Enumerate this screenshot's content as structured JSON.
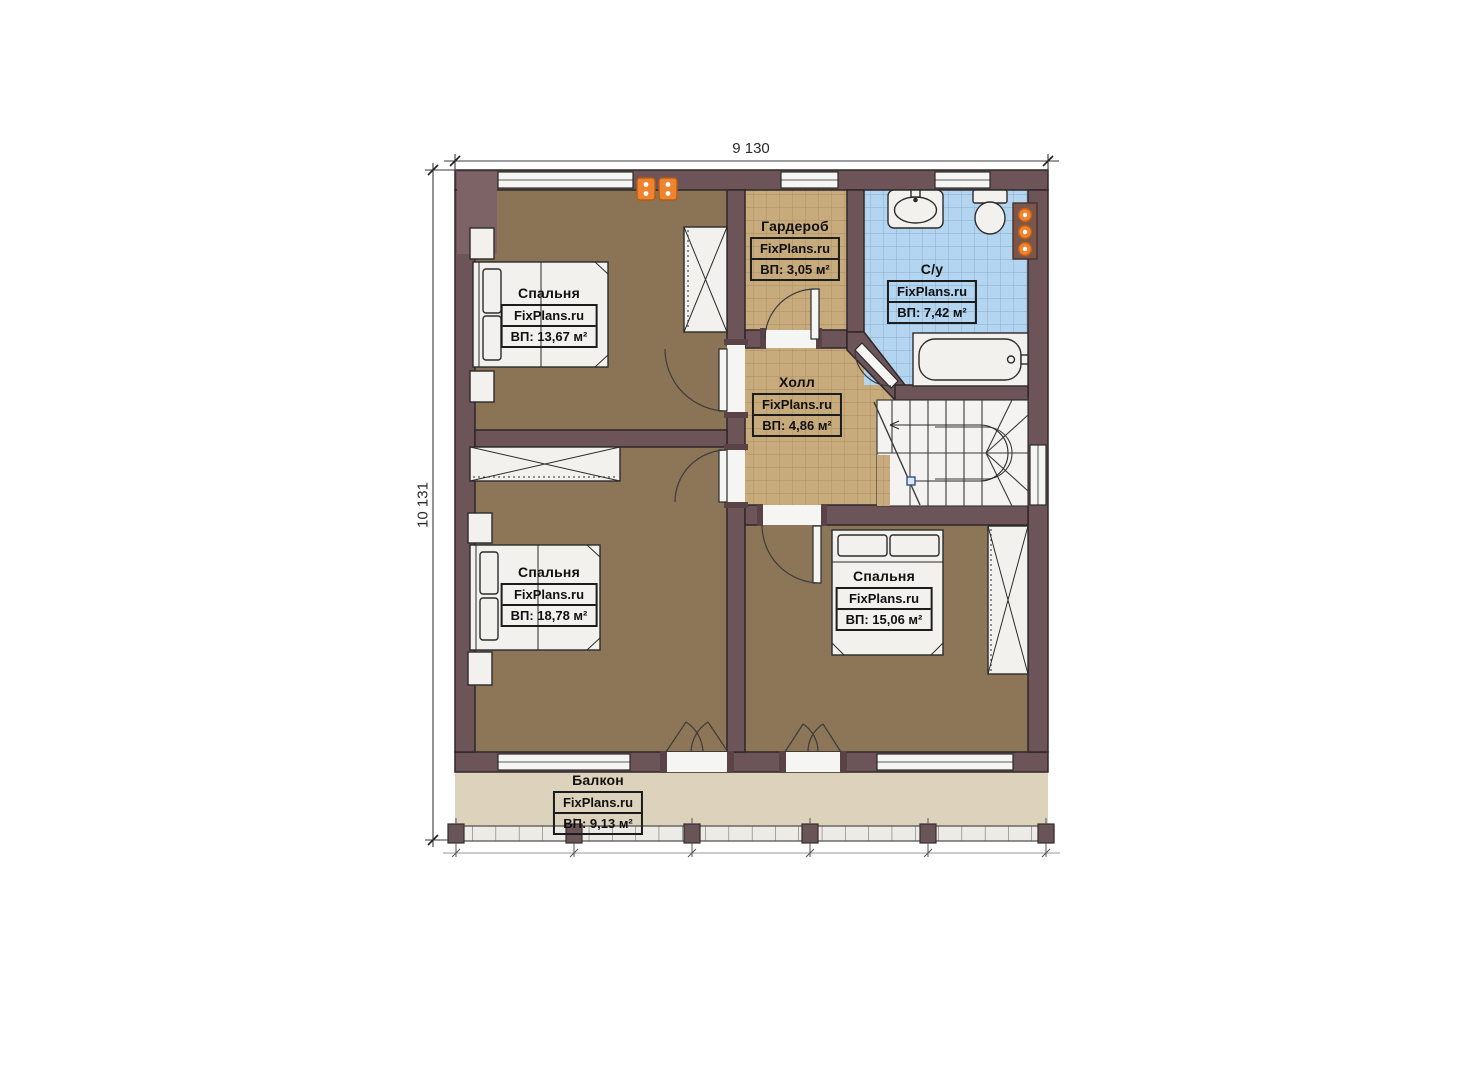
{
  "watermark": "FixPlans.ru",
  "dimensions": {
    "width": "9 130",
    "height": "10 131"
  },
  "rooms": [
    {
      "id": "bedroom-1",
      "name": "Спальня",
      "area_label": "ВП: 13,67 м²"
    },
    {
      "id": "wardrobe",
      "name": "Гардероб",
      "area_label": "ВП: 3,05 м²"
    },
    {
      "id": "bathroom",
      "name": "С/у",
      "area_label": "ВП: 7,42 м²"
    },
    {
      "id": "hall",
      "name": "Холл",
      "area_label": "ВП: 4,86 м²"
    },
    {
      "id": "bedroom-2",
      "name": "Спальня",
      "area_label": "ВП: 18,78 м²"
    },
    {
      "id": "bedroom-3",
      "name": "Спальня",
      "area_label": "ВП: 15,06 м²"
    },
    {
      "id": "balcony",
      "name": "Балкон",
      "area_label": "ВП: 9,13 м²"
    }
  ],
  "colors": {
    "wall": "#6d5458",
    "bedroom_floor": "#8b7356",
    "hall_tile": "#c8ab7d",
    "bath_tile": "#b3d5ef",
    "balcony_floor": "#ddd2bc",
    "radiator": "#ee8330",
    "stairs": "#f4f3f1"
  }
}
